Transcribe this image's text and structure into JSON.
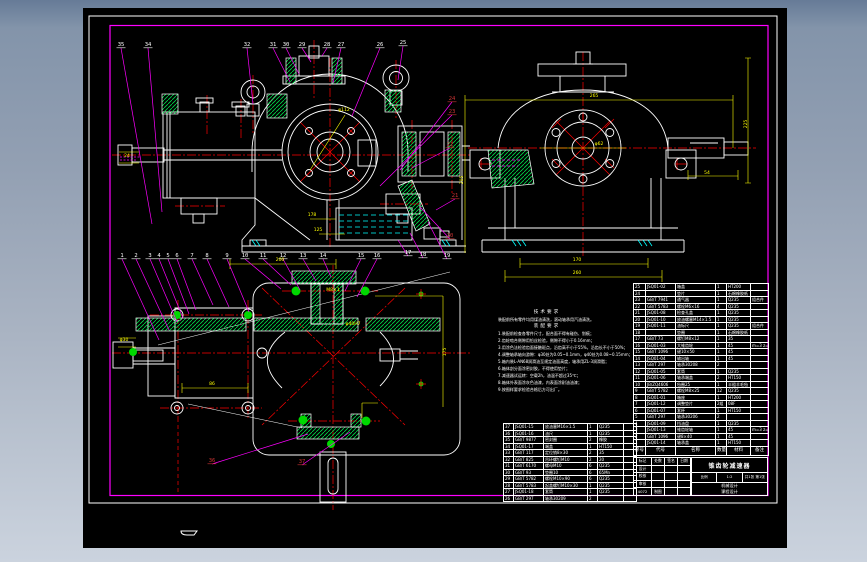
{
  "colors": {
    "white": "#ffffff",
    "red": "#ff0000",
    "balloon_red": "#cc3333",
    "magenta": "#ff00ff",
    "yellow": "#ffff00",
    "green": "#00d84a",
    "green_fill": "#00d800",
    "cyan": "#00ffff",
    "canvas": "#000000"
  },
  "sheet": {
    "title": "锥齿轮减速器",
    "scale_label": "比例",
    "scale": "1:2",
    "sheets": "共1张 第1张",
    "course1": "机械设计",
    "course2": "课程设计",
    "doc_no": "4072",
    "drawn": "制图"
  },
  "title_block": {
    "left_rows": [
      [
        "标记",
        "处数",
        "签名",
        "日期"
      ],
      [
        "设计",
        "",
        "",
        ""
      ],
      [
        "校核",
        "",
        "",
        ""
      ],
      [
        "审核",
        "",
        "",
        ""
      ],
      [
        "4072",
        "制图",
        "",
        ""
      ]
    ]
  },
  "notes": {
    "heading1": "技术要求",
    "intro": "装配前所有零件均用煤油清洗，滚动轴承用汽油清洗。",
    "heading2": "装配要求",
    "lines": [
      "1.装配前检查各零件尺寸，配合面不得有碰伤、划痕；",
      "2.齿轮啮合侧隙用铅丝检验，侧隙不得小于0.16mm；",
      "3.用涂色法检验齿面接触斑点，沿齿高不小于55%，沿齿长不小于50%；",
      "4.调整轴承轴向游隙：φ30处为0.05~0.1mm，φ40处为0.08~0.15mm；",
      "5.箱内装L-AN68润滑油至规定油面高度，轴承用ZL-3润滑脂；",
      "6.箱体剖分面涂密封胶，不得使用垫片；",
      "7.减速器试运转：空载2h，油温不超过35℃；",
      "8.箱体外表面涂灰色油漆，内表面涂耐油油漆；",
      "9.按图样要求检验合格后方可出厂。"
    ]
  },
  "balloons": [
    {
      "n": "35",
      "x": 121,
      "y": 46,
      "c": "w",
      "tx": 152,
      "ty": 224
    },
    {
      "n": "34",
      "x": 148,
      "y": 46,
      "c": "w",
      "tx": 162,
      "ty": 212
    },
    {
      "n": "32",
      "x": 247,
      "y": 46,
      "c": "w",
      "tx": 253,
      "ty": 104
    },
    {
      "n": "31",
      "x": 273,
      "y": 46,
      "c": "w",
      "tx": 290,
      "ty": 82
    },
    {
      "n": "30",
      "x": 286,
      "y": 46,
      "c": "w",
      "tx": 299,
      "ty": 74
    },
    {
      "n": "29",
      "x": 302,
      "y": 46,
      "c": "w",
      "tx": 311,
      "ty": 62
    },
    {
      "n": "28",
      "x": 327,
      "y": 46,
      "c": "w",
      "tx": 322,
      "ty": 56
    },
    {
      "n": "27",
      "x": 341,
      "y": 46,
      "c": "w",
      "tx": 333,
      "ty": 83
    },
    {
      "n": "26",
      "x": 380,
      "y": 46,
      "c": "w",
      "tx": 352,
      "ty": 116
    },
    {
      "n": "25",
      "x": 403,
      "y": 44,
      "c": "w",
      "tx": 398,
      "ty": 80
    },
    {
      "n": "24",
      "x": 452,
      "y": 100,
      "c": "r",
      "tx": 400,
      "ty": 170
    },
    {
      "n": "23",
      "x": 452,
      "y": 113,
      "c": "r",
      "tx": 380,
      "ty": 186
    },
    {
      "n": "22",
      "x": 450,
      "y": 146,
      "c": "r",
      "tx": 412,
      "ty": 168
    },
    {
      "n": "21",
      "x": 455,
      "y": 197,
      "c": "r",
      "tx": 436,
      "ty": 210
    },
    {
      "n": "20",
      "x": 450,
      "y": 237,
      "c": "r",
      "tx": 420,
      "ty": 207
    },
    {
      "n": "19",
      "x": 447,
      "y": 257,
      "c": "w",
      "tx": 428,
      "ty": 222
    },
    {
      "n": "18",
      "x": 423,
      "y": 256,
      "c": "w",
      "tx": 410,
      "ty": 233
    },
    {
      "n": "17",
      "x": 408,
      "y": 254,
      "c": "w",
      "tx": 398,
      "ty": 240
    },
    {
      "n": "16",
      "x": 377,
      "y": 257,
      "c": "w",
      "tx": 357,
      "ty": 297
    },
    {
      "n": "15",
      "x": 361,
      "y": 257,
      "c": "w",
      "tx": 345,
      "ty": 291
    },
    {
      "n": "14",
      "x": 323,
      "y": 257,
      "c": "w",
      "tx": 331,
      "ty": 277
    },
    {
      "n": "13",
      "x": 303,
      "y": 257,
      "c": "w",
      "tx": 316,
      "ty": 281
    },
    {
      "n": "12",
      "x": 283,
      "y": 257,
      "c": "w",
      "tx": 300,
      "ty": 290
    },
    {
      "n": "11",
      "x": 263,
      "y": 257,
      "c": "w",
      "tx": 291,
      "ty": 285
    },
    {
      "n": "10",
      "x": 245,
      "y": 257,
      "c": "w",
      "tx": 281,
      "ty": 289
    },
    {
      "n": "9",
      "x": 227,
      "y": 257,
      "c": "w",
      "tx": 249,
      "ty": 312
    },
    {
      "n": "8",
      "x": 207,
      "y": 257,
      "c": "w",
      "tx": 229,
      "ty": 307
    },
    {
      "n": "7",
      "x": 192,
      "y": 257,
      "c": "w",
      "tx": 213,
      "ty": 305
    },
    {
      "n": "6",
      "x": 177,
      "y": 257,
      "c": "w",
      "tx": 196,
      "ty": 310
    },
    {
      "n": "5",
      "x": 168,
      "y": 257,
      "c": "w",
      "tx": 189,
      "ty": 314
    },
    {
      "n": "4",
      "x": 159,
      "y": 257,
      "c": "w",
      "tx": 183,
      "ty": 318
    },
    {
      "n": "3",
      "x": 150,
      "y": 257,
      "c": "w",
      "tx": 177,
      "ty": 322
    },
    {
      "n": "2",
      "x": 136,
      "y": 257,
      "c": "w",
      "tx": 169,
      "ty": 330
    },
    {
      "n": "1",
      "x": 122,
      "y": 257,
      "c": "w",
      "tx": 159,
      "ty": 340
    },
    {
      "n": "36",
      "x": 212,
      "y": 462,
      "c": "r",
      "tx": 308,
      "ty": 434
    },
    {
      "n": "37",
      "x": 302,
      "y": 463,
      "c": "r",
      "tx": 350,
      "ty": 432
    }
  ],
  "dims": [
    {
      "t": "24",
      "x": 127,
      "y": 157
    },
    {
      "t": "φ112",
      "x": 344,
      "y": 111
    },
    {
      "t": "178",
      "x": 312,
      "y": 216
    },
    {
      "t": "125",
      "x": 318,
      "y": 231
    },
    {
      "t": "265",
      "x": 594,
      "y": 97
    },
    {
      "t": "φ62",
      "x": 599,
      "y": 145
    },
    {
      "t": "54",
      "x": 707,
      "y": 174
    },
    {
      "t": "225",
      "x": 747,
      "y": 124,
      "r": -90
    },
    {
      "t": "205",
      "x": 463,
      "y": 180,
      "r": -90
    },
    {
      "t": "170",
      "x": 577,
      "y": 261
    },
    {
      "t": "260",
      "x": 577,
      "y": 274
    },
    {
      "t": "200",
      "x": 280,
      "y": 261
    },
    {
      "t": "φ30",
      "x": 124,
      "y": 341
    },
    {
      "t": "86",
      "x": 212,
      "y": 385
    },
    {
      "t": "M8×1",
      "x": 333,
      "y": 291
    },
    {
      "t": "φ40H7",
      "x": 353,
      "y": 325
    },
    {
      "t": "175",
      "x": 446,
      "y": 352,
      "r": -90
    }
  ],
  "bom": {
    "headers": [
      "序号",
      "代号",
      "名称",
      "数量",
      "材料",
      "备注"
    ],
    "main_rows": [
      [
        "25",
        "JSQ01-02",
        "箱盖",
        "1",
        "HT200",
        ""
      ],
      [
        "24",
        "",
        "垫片",
        "1",
        "石棉橡胶纸",
        ""
      ],
      [
        "23",
        "GB/T 7941",
        "通气器",
        "1",
        "Q235",
        "组合件"
      ],
      [
        "22",
        "GB/T 5783",
        "螺栓M6×16",
        "4",
        "Q235",
        ""
      ],
      [
        "21",
        "JSQ01-08",
        "检查孔盖",
        "1",
        "Q235",
        ""
      ],
      [
        "20",
        "JSQ01-10",
        "放油螺塞M14×1.5",
        "1",
        "Q235",
        ""
      ],
      [
        "19",
        "JSQ01-11",
        "油标尺",
        "1",
        "Q235",
        "组合件"
      ],
      [
        "18",
        "",
        "垫圈",
        "1",
        "石棉橡胶纸",
        ""
      ],
      [
        "17",
        "GB/T 73",
        "螺钉M8×12",
        "1",
        "35",
        ""
      ],
      [
        "16",
        "JSQ01-03",
        "大锥齿轮",
        "1",
        "45",
        "m=3 z=48"
      ],
      [
        "15",
        "GB/T 1096",
        "键10×50",
        "1",
        "45",
        ""
      ],
      [
        "14",
        "JSQ01-04",
        "输出轴",
        "1",
        "45",
        ""
      ],
      [
        "13",
        "GB/T 297",
        "轴承30208",
        "2",
        "",
        ""
      ],
      [
        "12",
        "JSQ01-05",
        "套筒",
        "1",
        "Q235",
        ""
      ],
      [
        "11",
        "JSQ01-06",
        "轴承端盖",
        "2",
        "HT150",
        ""
      ],
      [
        "10",
        "JB/ZQ4606",
        "毡圈25",
        "1",
        "半粗羊毛毡",
        ""
      ],
      [
        "9",
        "GB/T 5782",
        "螺栓M8×25",
        "12",
        "Q235",
        ""
      ],
      [
        "8",
        "JSQ01-01",
        "箱座",
        "1",
        "HT200",
        ""
      ],
      [
        "7",
        "JSQ01-12",
        "调整垫片",
        "2组",
        "08F",
        ""
      ],
      [
        "6",
        "JSQ01-07",
        "套杯",
        "1",
        "HT150",
        ""
      ],
      [
        "5",
        "GB/T 297",
        "轴承30206",
        "2",
        "",
        ""
      ],
      [
        "4",
        "JSQ01-09",
        "挡油盘",
        "1",
        "Q235",
        ""
      ],
      [
        "3",
        "JSQ01-13",
        "锥齿轮轴",
        "1",
        "45",
        "m=3 z=16"
      ],
      [
        "2",
        "GB/T 1096",
        "键8×40",
        "1",
        "45",
        ""
      ],
      [
        "1",
        "JSQ01-14",
        "轴承盖",
        "1",
        "HT150",
        ""
      ]
    ],
    "overflow_rows": [
      [
        "37",
        "JSQ01-15",
        "放油塞M16×1.5",
        "1",
        "Q235",
        ""
      ],
      [
        "36",
        "JSQ01-16",
        "油尺",
        "1",
        "Q235",
        ""
      ],
      [
        "35",
        "GB/T 9877",
        "密封圈",
        "2",
        "橡胶",
        ""
      ],
      [
        "34",
        "JSQ01-17",
        "端盖",
        "1",
        "HT150",
        ""
      ],
      [
        "33",
        "GB/T 117",
        "定位销8×30",
        "2",
        "35",
        ""
      ],
      [
        "32",
        "GB/T 825",
        "吊环螺钉M10",
        "2",
        "20",
        ""
      ],
      [
        "31",
        "GB/T 6170",
        "螺母M10",
        "6",
        "Q235",
        ""
      ],
      [
        "30",
        "GB/T 93",
        "垫圈10",
        "6",
        "65Mn",
        ""
      ],
      [
        "29",
        "GB/T 5782",
        "螺栓M10×90",
        "6",
        "Q235",
        ""
      ],
      [
        "28",
        "GB/T 5783",
        "起盖螺钉M10×30",
        "1",
        "Q235",
        ""
      ],
      [
        "27",
        "JSQ01-18",
        "套筒",
        "1",
        "Q235",
        ""
      ],
      [
        "26",
        "GB/T 297",
        "轴承30209",
        "2",
        "",
        ""
      ]
    ]
  }
}
